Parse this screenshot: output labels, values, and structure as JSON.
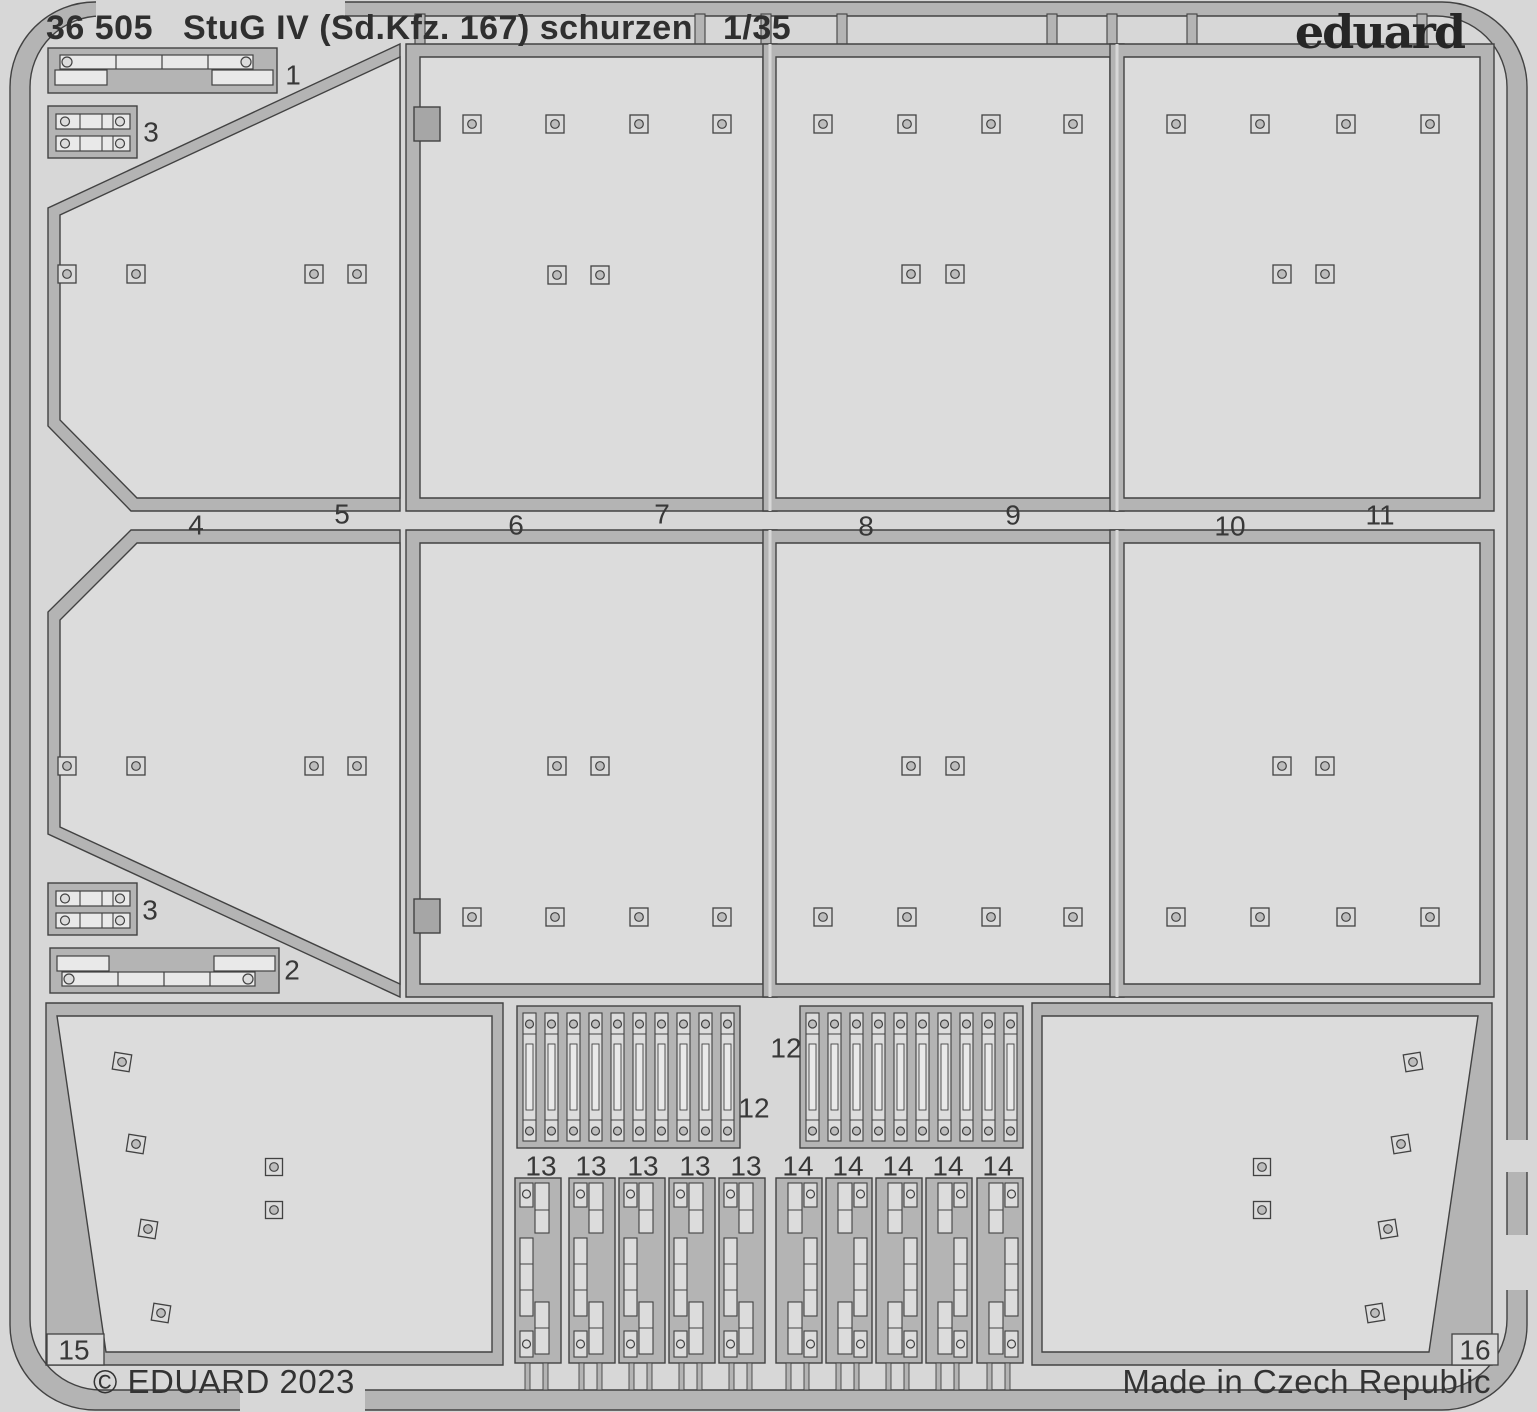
{
  "header": {
    "catalog_number": "36 505",
    "title": "StuG IV (Sd.Kfz. 167) schurzen",
    "scale": "1/35",
    "brand": "eduard"
  },
  "footer": {
    "copyright": "© EDUARD 2023",
    "origin": "Made in Czech Republic"
  },
  "colors": {
    "background": "#d7d7d7",
    "plate": "#dcdcdc",
    "runner": "#b4b4b4",
    "tab": "#a6a6a6",
    "outline": "#424242",
    "white": "#e9e9e9",
    "bolt_fill": "#bdbdbd",
    "label": "#383838"
  },
  "sheet": {
    "frame_gaps": [
      [
        96,
        0,
        249,
        18
      ],
      [
        240,
        1388,
        125,
        24
      ],
      [
        1503,
        1140,
        30,
        32
      ],
      [
        1503,
        1235,
        30,
        55
      ]
    ],
    "top_tabs": [
      420,
      700,
      766,
      842,
      1052,
      1112,
      1192,
      1422
    ],
    "panel_dividers": [
      [
        770,
        44,
        770,
        511
      ],
      [
        1117,
        44,
        1117,
        511
      ],
      [
        770,
        530,
        770,
        997
      ],
      [
        1117,
        530,
        1117,
        997
      ]
    ],
    "bolt_size": 18,
    "panels": [
      {
        "part": "5",
        "name": "schurzen-plate-5-upper-left-angled",
        "outer": "400,44 400,511 131,511 48,426 48,208",
        "inner": "400,57 400,498 137,498 60,420 60,215",
        "bolts": [
          [
            67,
            274
          ],
          [
            136,
            274
          ],
          [
            314,
            274
          ],
          [
            357,
            274
          ]
        ]
      },
      {
        "part": "7",
        "name": "schurzen-plate-7-upper",
        "outer": "406,44 777,44 777,511 406,511",
        "inner": "420,57 763,57 763,498 420,498",
        "notch": [
          414,
          107,
          26,
          34
        ],
        "bolts": [
          [
            472,
            124
          ],
          [
            555,
            124
          ],
          [
            639,
            124
          ],
          [
            722,
            124
          ],
          [
            557,
            275
          ],
          [
            600,
            275
          ]
        ]
      },
      {
        "part": "9",
        "name": "schurzen-plate-9-upper",
        "outer": "763,44 1124,44 1124,511 763,511",
        "inner": "776,57 1110,57 1110,498 776,498",
        "bolts": [
          [
            823,
            124
          ],
          [
            907,
            124
          ],
          [
            991,
            124
          ],
          [
            1073,
            124
          ],
          [
            911,
            274
          ],
          [
            955,
            274
          ]
        ]
      },
      {
        "part": "11",
        "name": "schurzen-plate-11-upper",
        "outer": "1110,44 1494,44 1494,511 1110,511",
        "inner": "1124,57 1480,57 1480,498 1124,498",
        "bolts": [
          [
            1176,
            124
          ],
          [
            1260,
            124
          ],
          [
            1346,
            124
          ],
          [
            1430,
            124
          ],
          [
            1282,
            274
          ],
          [
            1325,
            274
          ]
        ]
      },
      {
        "part": "4",
        "name": "schurzen-plate-4-lower-left-angled",
        "outer": "131,530 400,530 400,997 48,834 48,612",
        "inner": "137,543 400,543 400,984 60,827 60,620",
        "bolts": [
          [
            67,
            766
          ],
          [
            136,
            766
          ],
          [
            314,
            766
          ],
          [
            357,
            766
          ]
        ]
      },
      {
        "part": "6",
        "name": "schurzen-plate-6-lower",
        "outer": "406,530 777,530 777,997 406,997",
        "inner": "420,543 763,543 763,984 420,984",
        "notch": [
          414,
          899,
          26,
          34
        ],
        "bolts": [
          [
            557,
            766
          ],
          [
            600,
            766
          ],
          [
            472,
            917
          ],
          [
            555,
            917
          ],
          [
            639,
            917
          ],
          [
            722,
            917
          ]
        ]
      },
      {
        "part": "8",
        "name": "schurzen-plate-8-lower",
        "outer": "763,530 1124,530 1124,997 763,997",
        "inner": "776,543 1110,543 1110,984 776,984",
        "bolts": [
          [
            911,
            766
          ],
          [
            955,
            766
          ],
          [
            823,
            917
          ],
          [
            907,
            917
          ],
          [
            991,
            917
          ],
          [
            1073,
            917
          ]
        ]
      },
      {
        "part": "10",
        "name": "schurzen-plate-10-lower",
        "outer": "1110,530 1494,530 1494,997 1110,997",
        "inner": "1124,543 1480,543 1480,984 1124,984",
        "bolts": [
          [
            1282,
            766
          ],
          [
            1325,
            766
          ],
          [
            1176,
            917
          ],
          [
            1260,
            917
          ],
          [
            1346,
            917
          ],
          [
            1430,
            917
          ]
        ]
      }
    ],
    "rail_brackets": [
      {
        "part": "1",
        "name": "mounting-rail-1",
        "x": 48,
        "y": 48,
        "mirror": false
      },
      {
        "part": "2",
        "name": "mounting-rail-2",
        "x": 50,
        "y": 948,
        "mirror": true
      }
    ],
    "clamp_brackets": [
      {
        "part": "3",
        "name": "clamp-bracket-3a",
        "x": 48,
        "y": 106
      },
      {
        "part": "3",
        "name": "clamp-bracket-3b",
        "x": 48,
        "y": 883
      }
    ],
    "hanger_strip_blocks": [
      {
        "part": "12",
        "name": "hanger-strips-12-left",
        "x": 517,
        "y": 1006,
        "w": 223,
        "h": 142,
        "count": 10
      },
      {
        "part": "12",
        "name": "hanger-strips-12-right",
        "x": 800,
        "y": 1006,
        "w": 223,
        "h": 142,
        "count": 10
      }
    ],
    "bracket_columns_13": {
      "name": "hanger-bracket-13",
      "xs": [
        515,
        569,
        619,
        669,
        719
      ],
      "y": 1178,
      "w": 46,
      "h": 185
    },
    "bracket_columns_14": {
      "name": "hanger-bracket-14",
      "xs": [
        776,
        826,
        876,
        926,
        977
      ],
      "y": 1178,
      "w": 46,
      "h": 185
    },
    "end_plates": [
      {
        "part": "15",
        "name": "end-plate-15",
        "outer": "46,1003 503,1003 503,1365 46,1365",
        "inner": "57,1016 492,1016 492,1352 106,1352",
        "notch": [
          47,
          1334,
          57,
          31
        ],
        "bolts_tilted": [
          [
            122,
            1062
          ],
          [
            136,
            1144
          ],
          [
            148,
            1229
          ],
          [
            161,
            1313
          ]
        ],
        "tilt": 9,
        "bolts": [
          [
            274,
            1167
          ],
          [
            274,
            1210
          ]
        ]
      },
      {
        "part": "16",
        "name": "end-plate-16",
        "outer": "1032,1003 1492,1003 1492,1365 1032,1365",
        "inner": "1042,1016 1478,1016 1429,1352 1042,1352",
        "notch": [
          1452,
          1334,
          46,
          31
        ],
        "bolts_tilted": [
          [
            1413,
            1062
          ],
          [
            1401,
            1144
          ],
          [
            1388,
            1229
          ],
          [
            1375,
            1313
          ]
        ],
        "tilt": -9,
        "bolts": [
          [
            1262,
            1167
          ],
          [
            1262,
            1210
          ]
        ]
      }
    ],
    "part_labels": [
      {
        "t": "1",
        "x": 293,
        "y": 75
      },
      {
        "t": "3",
        "x": 151,
        "y": 132
      },
      {
        "t": "3",
        "x": 150,
        "y": 910
      },
      {
        "t": "2",
        "x": 292,
        "y": 970
      },
      {
        "t": "4",
        "x": 196,
        "y": 525
      },
      {
        "t": "5",
        "x": 342,
        "y": 514
      },
      {
        "t": "6",
        "x": 516,
        "y": 525
      },
      {
        "t": "7",
        "x": 662,
        "y": 514
      },
      {
        "t": "8",
        "x": 866,
        "y": 526
      },
      {
        "t": "9",
        "x": 1013,
        "y": 515
      },
      {
        "t": "10",
        "x": 1230,
        "y": 526
      },
      {
        "t": "11",
        "x": 1380,
        "y": 515
      },
      {
        "t": "12",
        "x": 754,
        "y": 1108
      },
      {
        "t": "12",
        "x": 786,
        "y": 1048
      },
      {
        "t": "13",
        "x": 541,
        "y": 1166
      },
      {
        "t": "13",
        "x": 591,
        "y": 1166
      },
      {
        "t": "13",
        "x": 643,
        "y": 1166
      },
      {
        "t": "13",
        "x": 695,
        "y": 1166
      },
      {
        "t": "13",
        "x": 746,
        "y": 1166
      },
      {
        "t": "14",
        "x": 798,
        "y": 1166
      },
      {
        "t": "14",
        "x": 848,
        "y": 1166
      },
      {
        "t": "14",
        "x": 898,
        "y": 1166
      },
      {
        "t": "14",
        "x": 948,
        "y": 1166
      },
      {
        "t": "14",
        "x": 998,
        "y": 1166
      },
      {
        "t": "15",
        "x": 74,
        "y": 1350
      },
      {
        "t": "16",
        "x": 1475,
        "y": 1350
      }
    ]
  }
}
